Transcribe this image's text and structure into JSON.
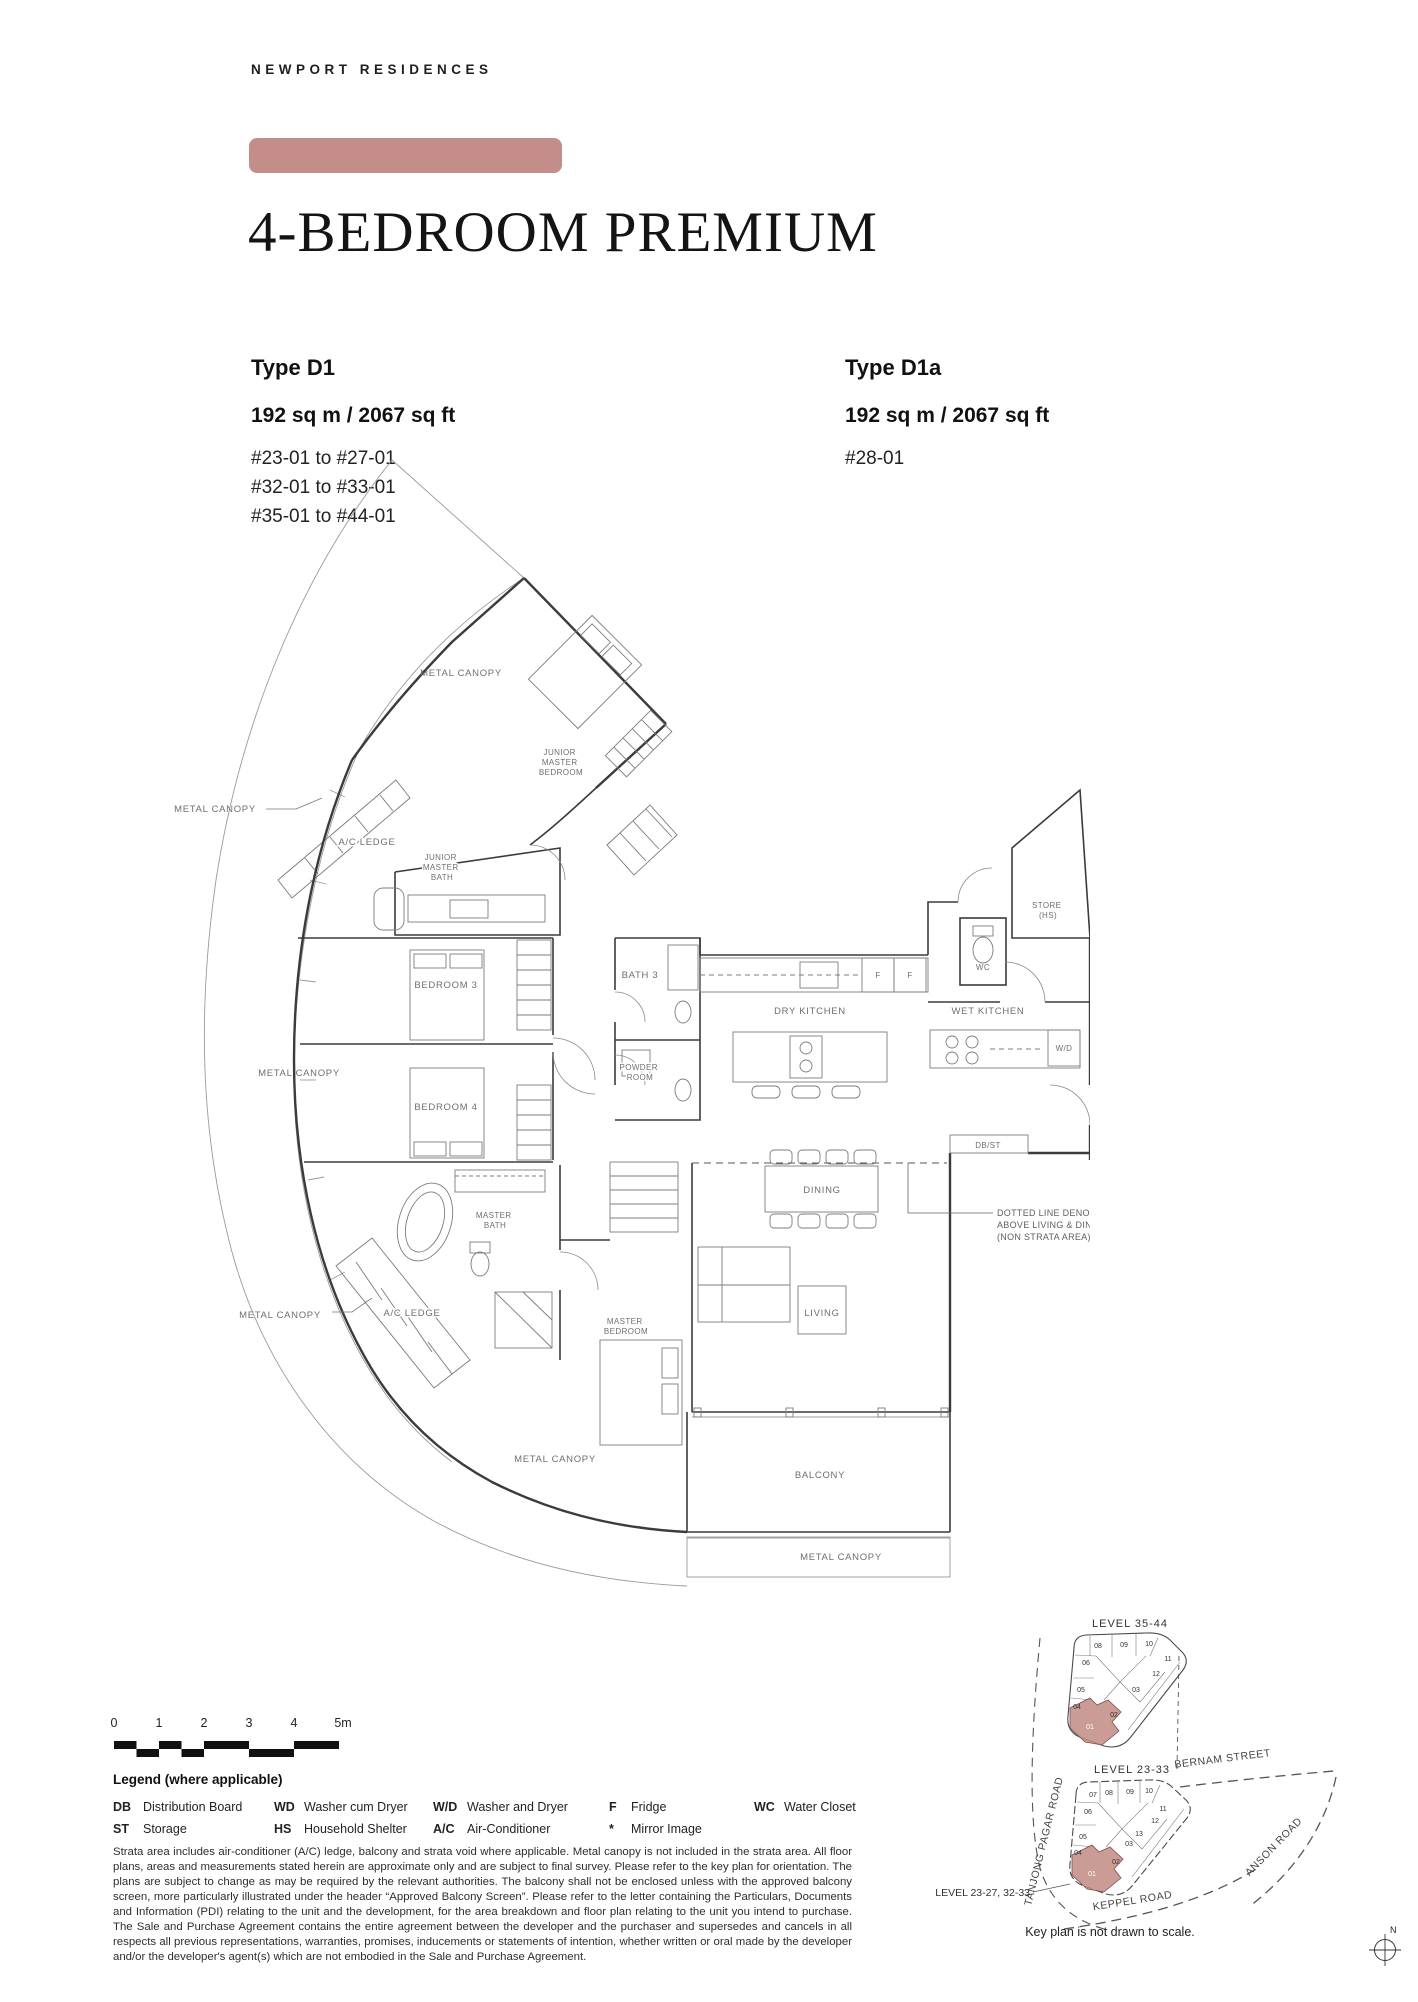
{
  "page": {
    "brand": "NEWPORT RESIDENCES",
    "title": "4-BEDROOM PREMIUM"
  },
  "accent_color": "#c38e89",
  "types": [
    {
      "name": "Type D1",
      "area": "192 sq m / 2067 sq ft",
      "units": [
        "#23-01 to #27-01",
        "#32-01 to #33-01",
        "#35-01 to #44-01"
      ]
    },
    {
      "name": "Type D1a",
      "area": "192 sq m / 2067 sq ft",
      "units": [
        "#28-01"
      ]
    }
  ],
  "floor_plan": {
    "labels": {
      "metal_canopy": "METAL CANOPY",
      "ac_ledge": "A/C LEDGE",
      "junior_master_bedroom": [
        "JUNIOR",
        "MASTER",
        "BEDROOM"
      ],
      "junior_master_bath": [
        "JUNIOR",
        "MASTER",
        "BATH"
      ],
      "bedroom_3": "BEDROOM 3",
      "bedroom_4": "BEDROOM 4",
      "bath_3": "BATH 3",
      "powder_room": [
        "POWDER",
        "ROOM"
      ],
      "dry_kitchen": "DRY KITCHEN",
      "wet_kitchen": "WET KITCHEN",
      "wc": "WC",
      "store": [
        "STORE",
        "(HS)"
      ],
      "wd": "W/D",
      "fridge": "F",
      "db_st": "DB/ST",
      "dining": "DINING",
      "living": "LIVING",
      "master_bath": [
        "MASTER",
        "BATH"
      ],
      "master_bedroom": [
        "MASTER",
        "BEDROOM"
      ],
      "balcony": "BALCONY",
      "high_ceiling_note": [
        "DOTTED LINE DENOTES HIGH CEILING",
        "ABOVE LIVING & DINING",
        "(NON STRATA AREA) FOR TYPE D1a"
      ]
    }
  },
  "scale_bar": {
    "ticks": [
      "0",
      "1",
      "2",
      "3",
      "4",
      "5m"
    ]
  },
  "legend": {
    "title": "Legend (where applicable)",
    "items": [
      {
        "abbr": "DB",
        "label": "Distribution Board"
      },
      {
        "abbr": "ST",
        "label": "Storage"
      },
      {
        "abbr": "WD",
        "label": "Washer cum Dryer"
      },
      {
        "abbr": "HS",
        "label": "Household Shelter"
      },
      {
        "abbr": "W/D",
        "label": "Washer and Dryer"
      },
      {
        "abbr": "A/C",
        "label": "Air-Conditioner"
      },
      {
        "abbr": "F",
        "label": "Fridge"
      },
      {
        "abbr": "*",
        "label": "Mirror Image"
      },
      {
        "abbr": "WC",
        "label": "Water Closet"
      }
    ]
  },
  "disclaimer": "Strata area includes air-conditioner (A/C) ledge, balcony and strata void where applicable. Metal canopy is not included in the strata area. All floor plans, areas and measurements stated herein are approximate only and are subject to final survey. Please refer to the key plan for orientation. The plans are subject to change as may be required by the relevant authorities. The balcony shall not be enclosed unless with the approved balcony screen, more particularly illustrated under the header “Approved Balcony Screen”. Please refer to the letter containing the Particulars, Documents and Information (PDI) relating to the unit and the development, for the area breakdown and floor plan relating to the unit you intend to purchase. The Sale and Purchase Agreement contains the entire agreement between the developer and the purchaser and supersedes and cancels in all respects all previous representations, warranties, promises, inducements or statements of intention, whether written or oral made by the developer and/or the developer's agent(s) which are not embodied in the Sale and Purchase Agreement.",
  "keyplans": {
    "upper": {
      "title": "LEVEL 35-44",
      "units": [
        "08",
        "09",
        "10",
        "11",
        "12",
        "06",
        "05",
        "04",
        "03",
        "02",
        "01"
      ]
    },
    "lower": {
      "title": "LEVEL 23-33",
      "units": [
        "07",
        "08",
        "09",
        "10",
        "11",
        "12",
        "13",
        "06",
        "05",
        "04",
        "03",
        "02",
        "01"
      ]
    },
    "callout": "LEVEL 23-27, 32-33",
    "roads": {
      "tanjong": "TANJONG PAGAR ROAD",
      "bernam": "BERNAM STREET",
      "anson": "ANSON ROAD",
      "keppel": "KEPPEL ROAD"
    },
    "note": "Key plan is not drawn to scale.",
    "compass_n": "N"
  }
}
